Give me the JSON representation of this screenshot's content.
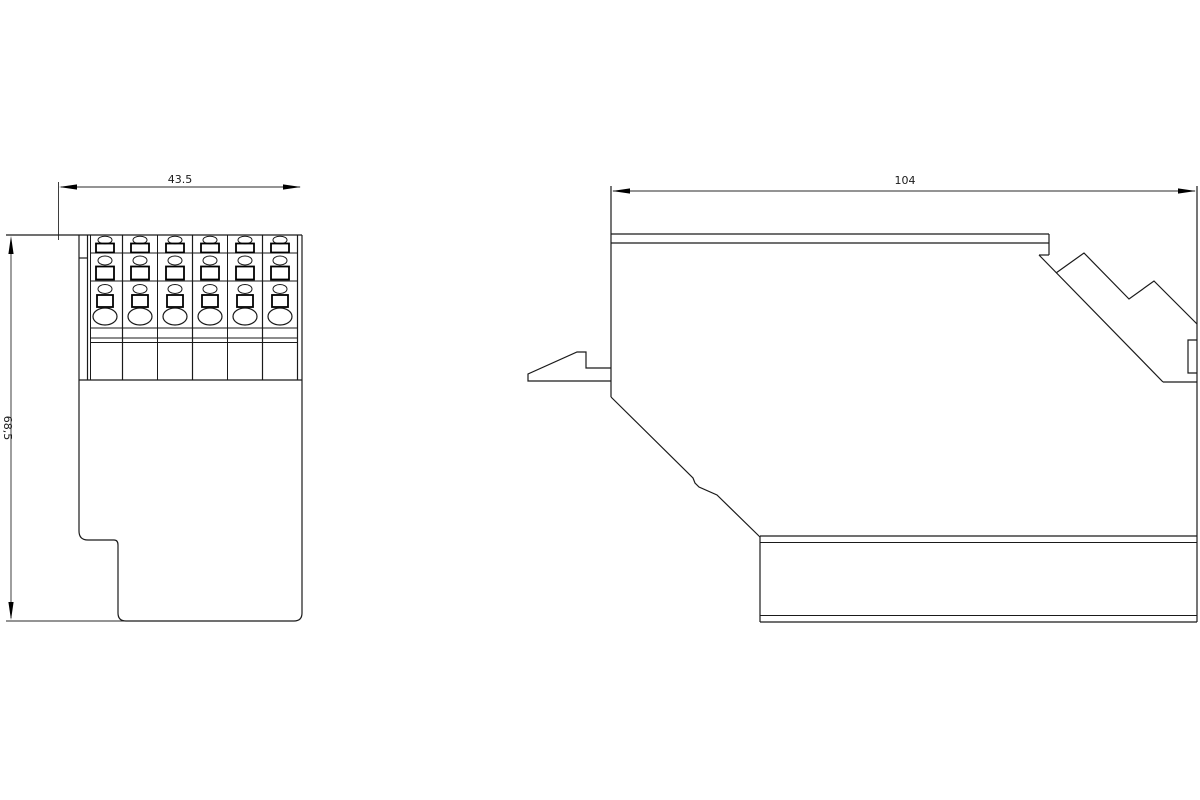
{
  "front_view": {
    "width_label": "43.5",
    "height_label": "68,5",
    "terminal_columns": 6
  },
  "side_view": {
    "width_label": "104"
  },
  "colors": {
    "line": "#000000",
    "background": "#ffffff"
  }
}
